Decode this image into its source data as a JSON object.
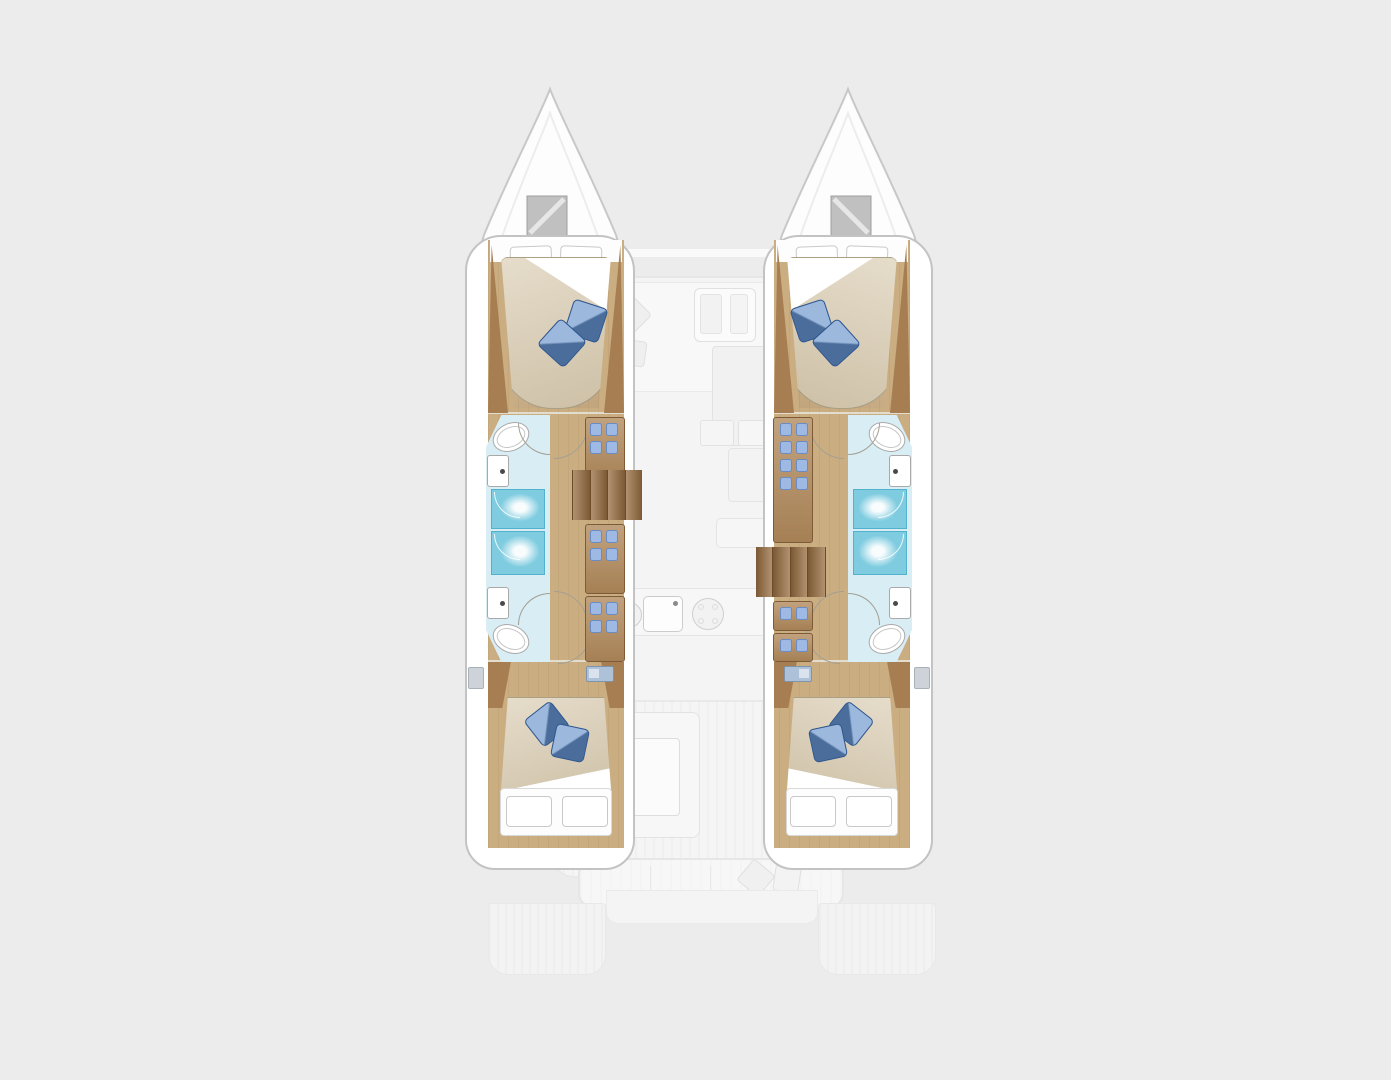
{
  "scene_label": "Catamaran yacht floor plan, top view, 4 cabins and 4 heads",
  "palette": {
    "background": "#ececec",
    "hull_white": "#ffffff",
    "hull_outline": "#c3c3c3",
    "faded_fill": "#f4f4f4",
    "faded_line": "#e6e6e6",
    "wood_floor": "#cbad82",
    "wood_panel": "#a77e51",
    "cabinet_wood": "#b0885a",
    "stair_wood": "#976d40",
    "bed_duvet": "#d8caaf",
    "bed_sheet": "#ffffff",
    "pillow_blue": "#5f8cc7",
    "bath_floor": "#d9edf5",
    "shower_tray": "#7fcce0",
    "porcelain": "#ffffff",
    "deck_hatch": "#c0c0c0",
    "window_glass": "#adc2d8"
  },
  "boat": {
    "hulls": [
      {
        "id": "port-hull",
        "rooms": [
          "forward-cabin",
          "forward-head",
          "shower-stalls",
          "aft-head",
          "aft-cabin"
        ],
        "fixtures": {
          "double_beds": 2,
          "toilets": 2,
          "sinks": 2,
          "showers": 2,
          "companionway_stairs": 1,
          "wardrobe_units": 3
        }
      },
      {
        "id": "starboard-hull",
        "rooms": [
          "forward-cabin",
          "forward-head",
          "shower-stalls",
          "aft-head",
          "aft-cabin"
        ],
        "fixtures": {
          "double_beds": 2,
          "toilets": 2,
          "sinks": 2,
          "showers": 2,
          "companionway_stairs": 1,
          "wardrobe_units": 3
        }
      }
    ],
    "saloon": {
      "features": [
        "forward-cockpit-seating",
        "forward-table",
        "saloon-sofa",
        "chaise-lounge",
        "galley-counter",
        "galley-sink",
        "stove-burners",
        "nav-seat"
      ]
    },
    "cockpit": {
      "features": [
        "cockpit-sofa",
        "cockpit-table",
        "side-seat",
        "aft-bench",
        "swim-platform",
        "transom-steps-port",
        "transom-steps-starboard"
      ]
    },
    "foredeck": {
      "features": [
        "bow-port",
        "bow-starboard",
        "deck-hatch-port",
        "deck-hatch-starboard",
        "forward-crossbeam"
      ]
    }
  }
}
